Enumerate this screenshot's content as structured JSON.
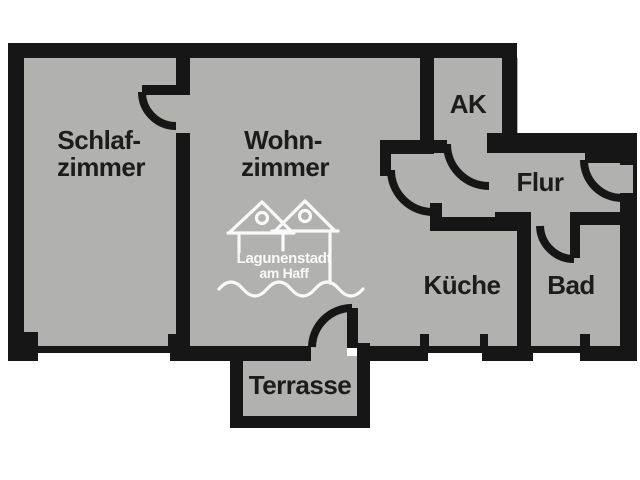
{
  "plan": {
    "type": "apartment-floorplan",
    "rooms": {
      "schlafzimmer": {
        "line1": "Schlaf-",
        "line2": "zimmer"
      },
      "wohnzimmer": {
        "line1": "Wohn-",
        "line2": "zimmer"
      },
      "ak": {
        "label": "AK"
      },
      "flur": {
        "label": "Flur"
      },
      "kueche": {
        "label": "Küche"
      },
      "bad": {
        "label": "Bad"
      },
      "terrasse": {
        "label": "Terrasse"
      }
    },
    "logo": {
      "line1": "Lagunenstadt",
      "line2": "am Haff"
    },
    "colors": {
      "wall": "#161616",
      "floor": "#b1b1b0",
      "background": "#ffffff",
      "label": "#1c1c1c",
      "logo": "#fafafa"
    }
  }
}
